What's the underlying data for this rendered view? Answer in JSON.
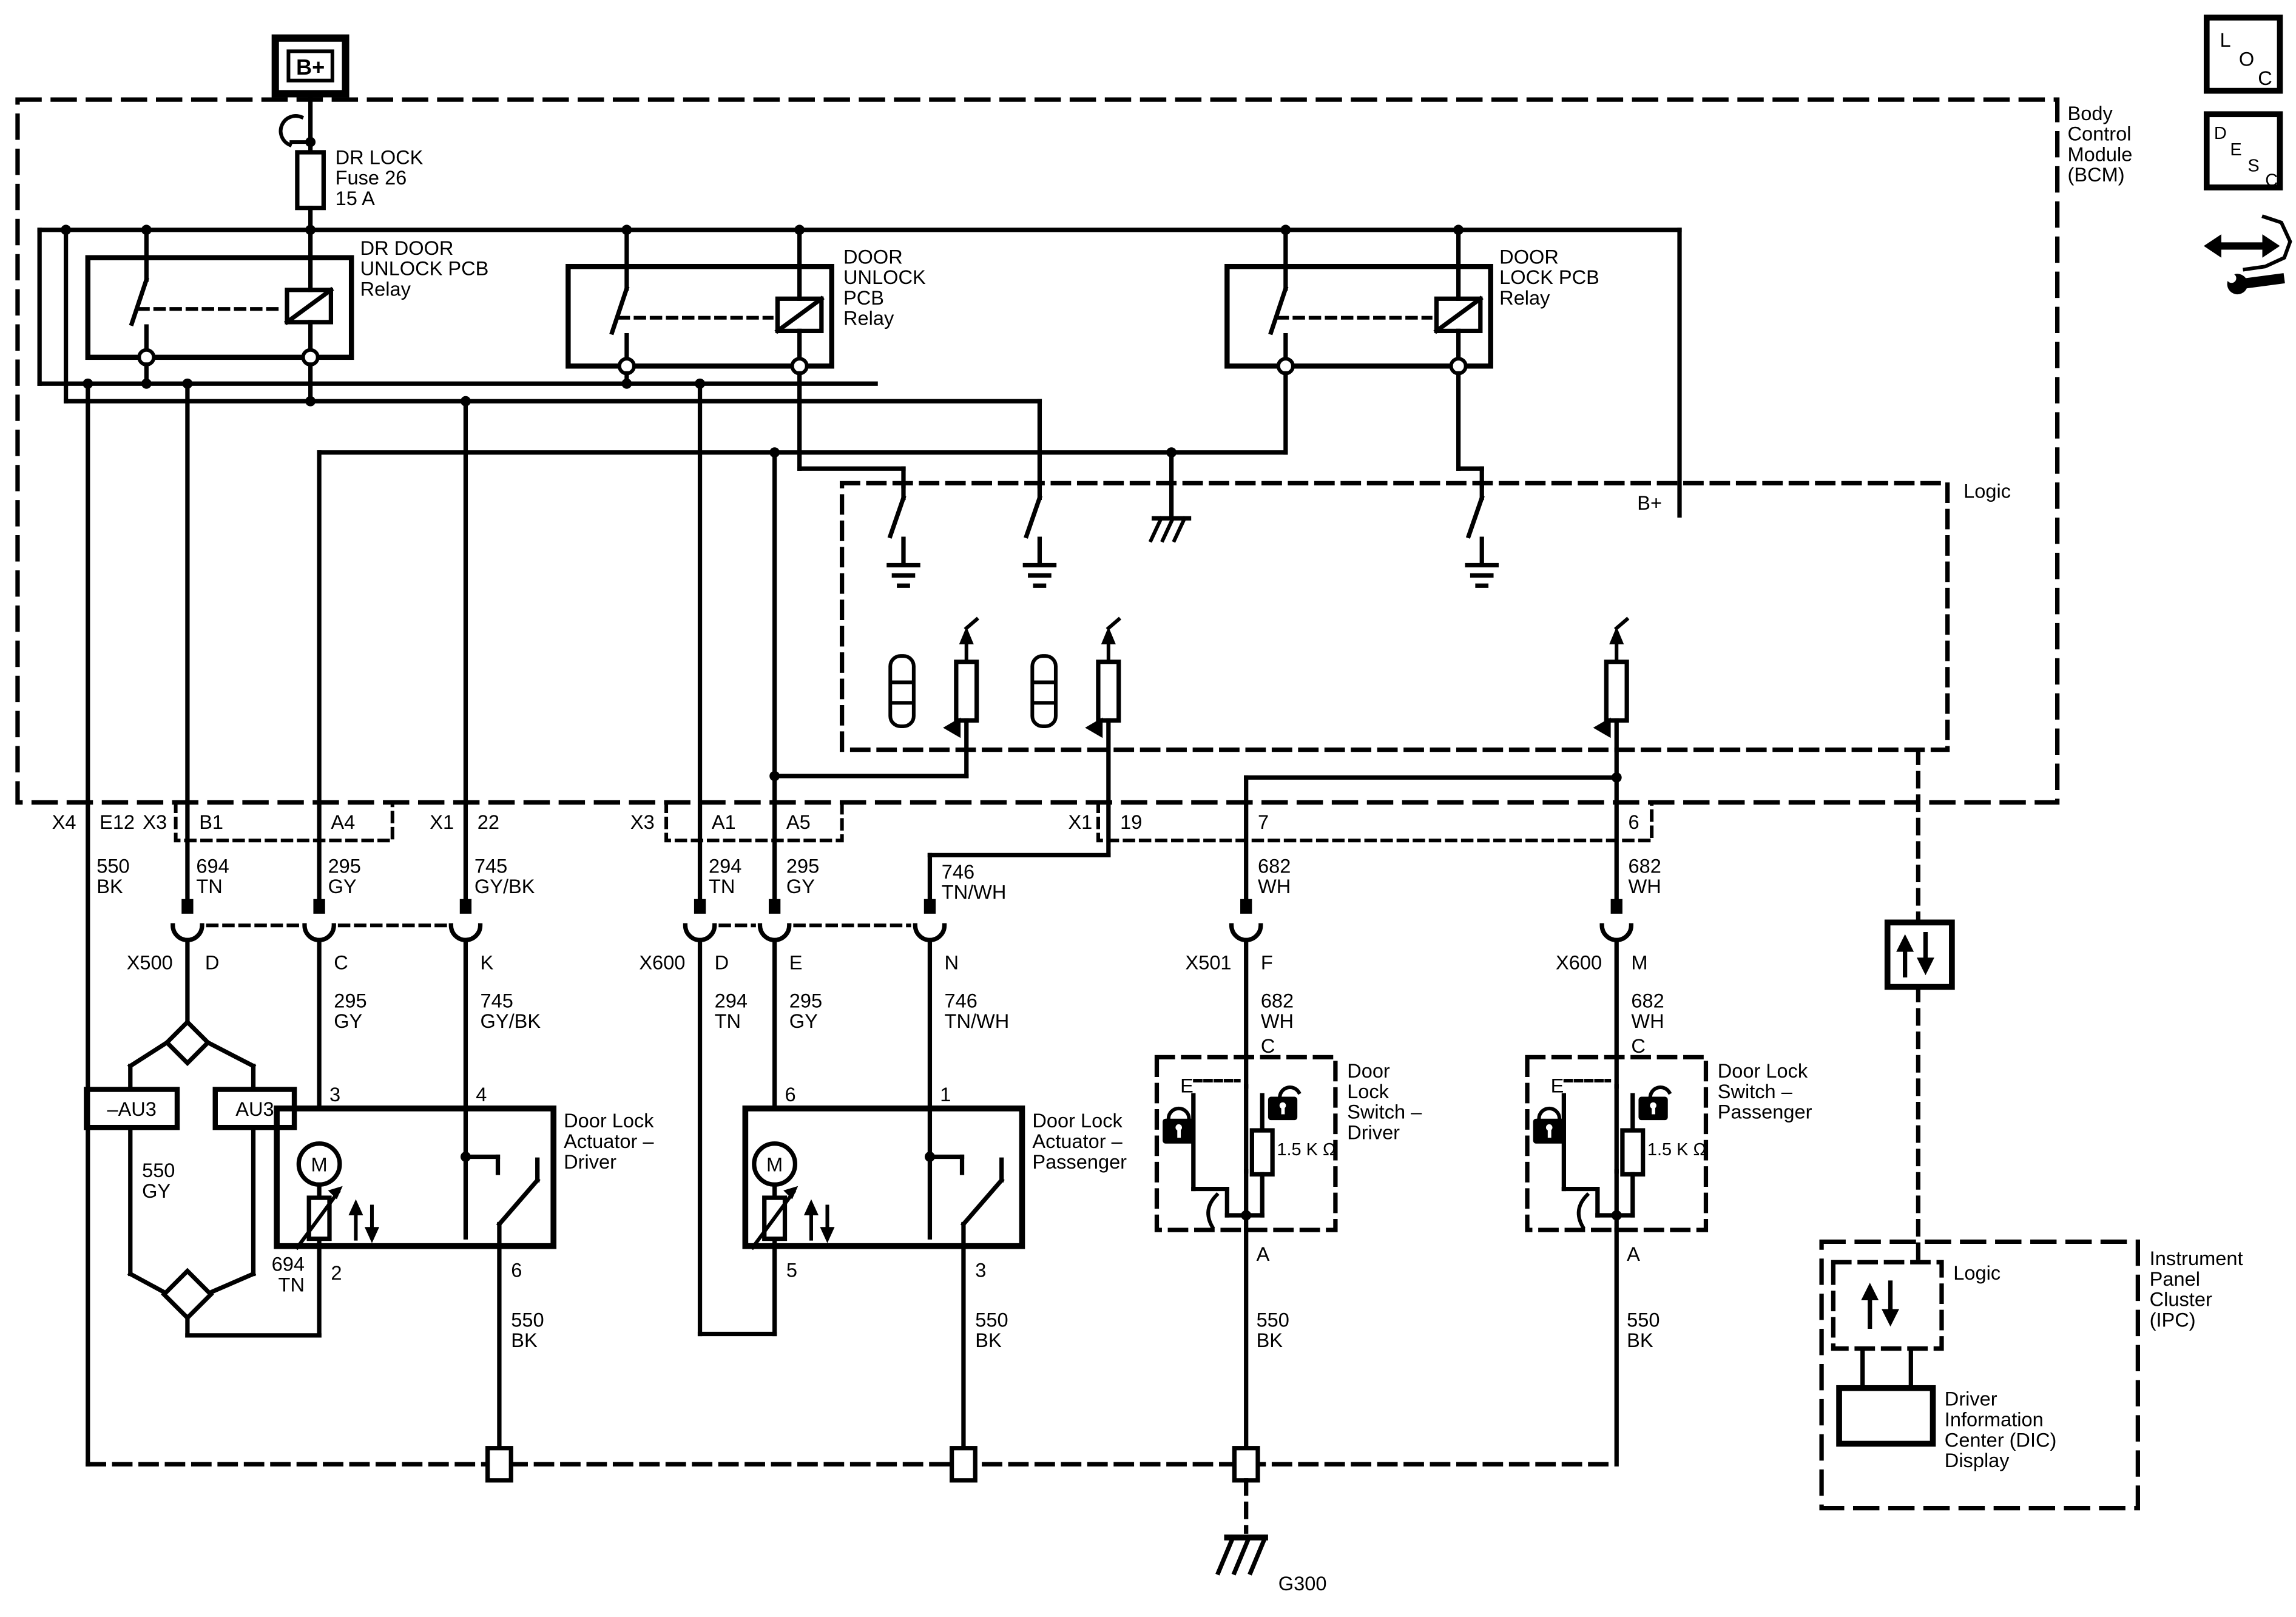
{
  "icons": {
    "loc": [
      "L",
      "O",
      "C"
    ],
    "desc": [
      "D",
      "E",
      "S",
      "C"
    ]
  },
  "bcm": {
    "label": [
      "Body",
      "Control",
      "Module",
      "(BCM)"
    ],
    "logic_label": "Logic",
    "b_plus_label": "B+"
  },
  "power": {
    "b_plus": "B+",
    "fuse_label": [
      "DR LOCK",
      "Fuse 26",
      "15 A"
    ]
  },
  "relays": {
    "dr_door_unlock": [
      "DR DOOR",
      "UNLOCK PCB",
      "Relay"
    ],
    "door_unlock": [
      "DOOR",
      "UNLOCK",
      "PCB",
      "Relay"
    ],
    "door_lock": [
      "DOOR",
      "LOCK PCB",
      "Relay"
    ]
  },
  "border_pins": {
    "x4": "X4",
    "e12": "E12",
    "x3_a": "X3",
    "b1": "B1",
    "a4": "A4",
    "x1_a": "X1",
    "p22": "22",
    "x3_b": "X3",
    "a1": "A1",
    "a5": "A5",
    "x1_b": "X1",
    "p19": "19",
    "p7": "7",
    "p6": "6"
  },
  "wire_labels": {
    "bk_x4": [
      "550",
      "BK"
    ],
    "tn_b1": [
      "694",
      "TN"
    ],
    "gy_a4": [
      "295",
      "GY"
    ],
    "gybk_22": [
      "745",
      "GY/BK"
    ],
    "tn_a1": [
      "294",
      "TN"
    ],
    "gy_a5": [
      "295",
      "GY"
    ],
    "tnwh_19": [
      "746",
      "TN/WH"
    ],
    "wh_7": [
      "682",
      "WH"
    ],
    "wh_6": [
      "682",
      "WH"
    ],
    "gy_c": [
      "295",
      "GY"
    ],
    "gybk_k": [
      "745",
      "GY/BK"
    ],
    "tn_d": [
      "294",
      "TN"
    ],
    "gy_e": [
      "295",
      "GY"
    ],
    "tnwh_n": [
      "746",
      "TN/WH"
    ],
    "wh_f": [
      "682",
      "WH"
    ],
    "wh_m": [
      "682",
      "WH"
    ],
    "gy_au3": [
      "550",
      "GY"
    ],
    "tn_splice": [
      "694",
      "TN"
    ],
    "bk_act_driver": [
      "550",
      "BK"
    ],
    "bk_act_pass": [
      "550",
      "BK"
    ],
    "bk_sw_driver": [
      "550",
      "BK"
    ],
    "bk_sw_pass": [
      "550",
      "BK"
    ]
  },
  "connectors": {
    "x500": "X500",
    "x600_act": "X600",
    "x501": "X501",
    "x600_sw": "X600",
    "pin_d1": "D",
    "pin_c": "C",
    "pin_k": "K",
    "pin_d2": "D",
    "pin_e": "E",
    "pin_n": "N",
    "pin_f": "F",
    "pin_m": "M",
    "pin_c_sw1": "C",
    "pin_c_sw2": "C"
  },
  "splices": {
    "au3_minus": "–AU3",
    "au3": "AU3"
  },
  "actuator_driver": {
    "label": [
      "Door Lock",
      "Actuator –",
      "Driver"
    ],
    "motor": "M",
    "pin3": "3",
    "pin4": "4",
    "pin2": "2",
    "pin6": "6"
  },
  "actuator_passenger": {
    "label": [
      "Door Lock",
      "Actuator –",
      "Passenger"
    ],
    "motor": "M",
    "pin6": "6",
    "pin1": "1",
    "pin5": "5",
    "pin3": "3"
  },
  "switch_driver": {
    "label": [
      "Door",
      "Lock",
      "Switch –",
      "Driver"
    ],
    "e": "E",
    "resistor": "1.5 K Ω",
    "pin_a": "A"
  },
  "switch_passenger": {
    "label": [
      "Door Lock",
      "Switch –",
      "Passenger"
    ],
    "e": "E",
    "resistor": "1.5 K Ω",
    "pin_a": "A"
  },
  "grounds": {
    "g300": "G300"
  },
  "ipc": {
    "label": [
      "Instrument",
      "Panel",
      "Cluster",
      "(IPC)"
    ],
    "logic_label": "Logic",
    "dic_label": [
      "Driver",
      "Information",
      "Center (DIC)",
      "Display"
    ]
  }
}
